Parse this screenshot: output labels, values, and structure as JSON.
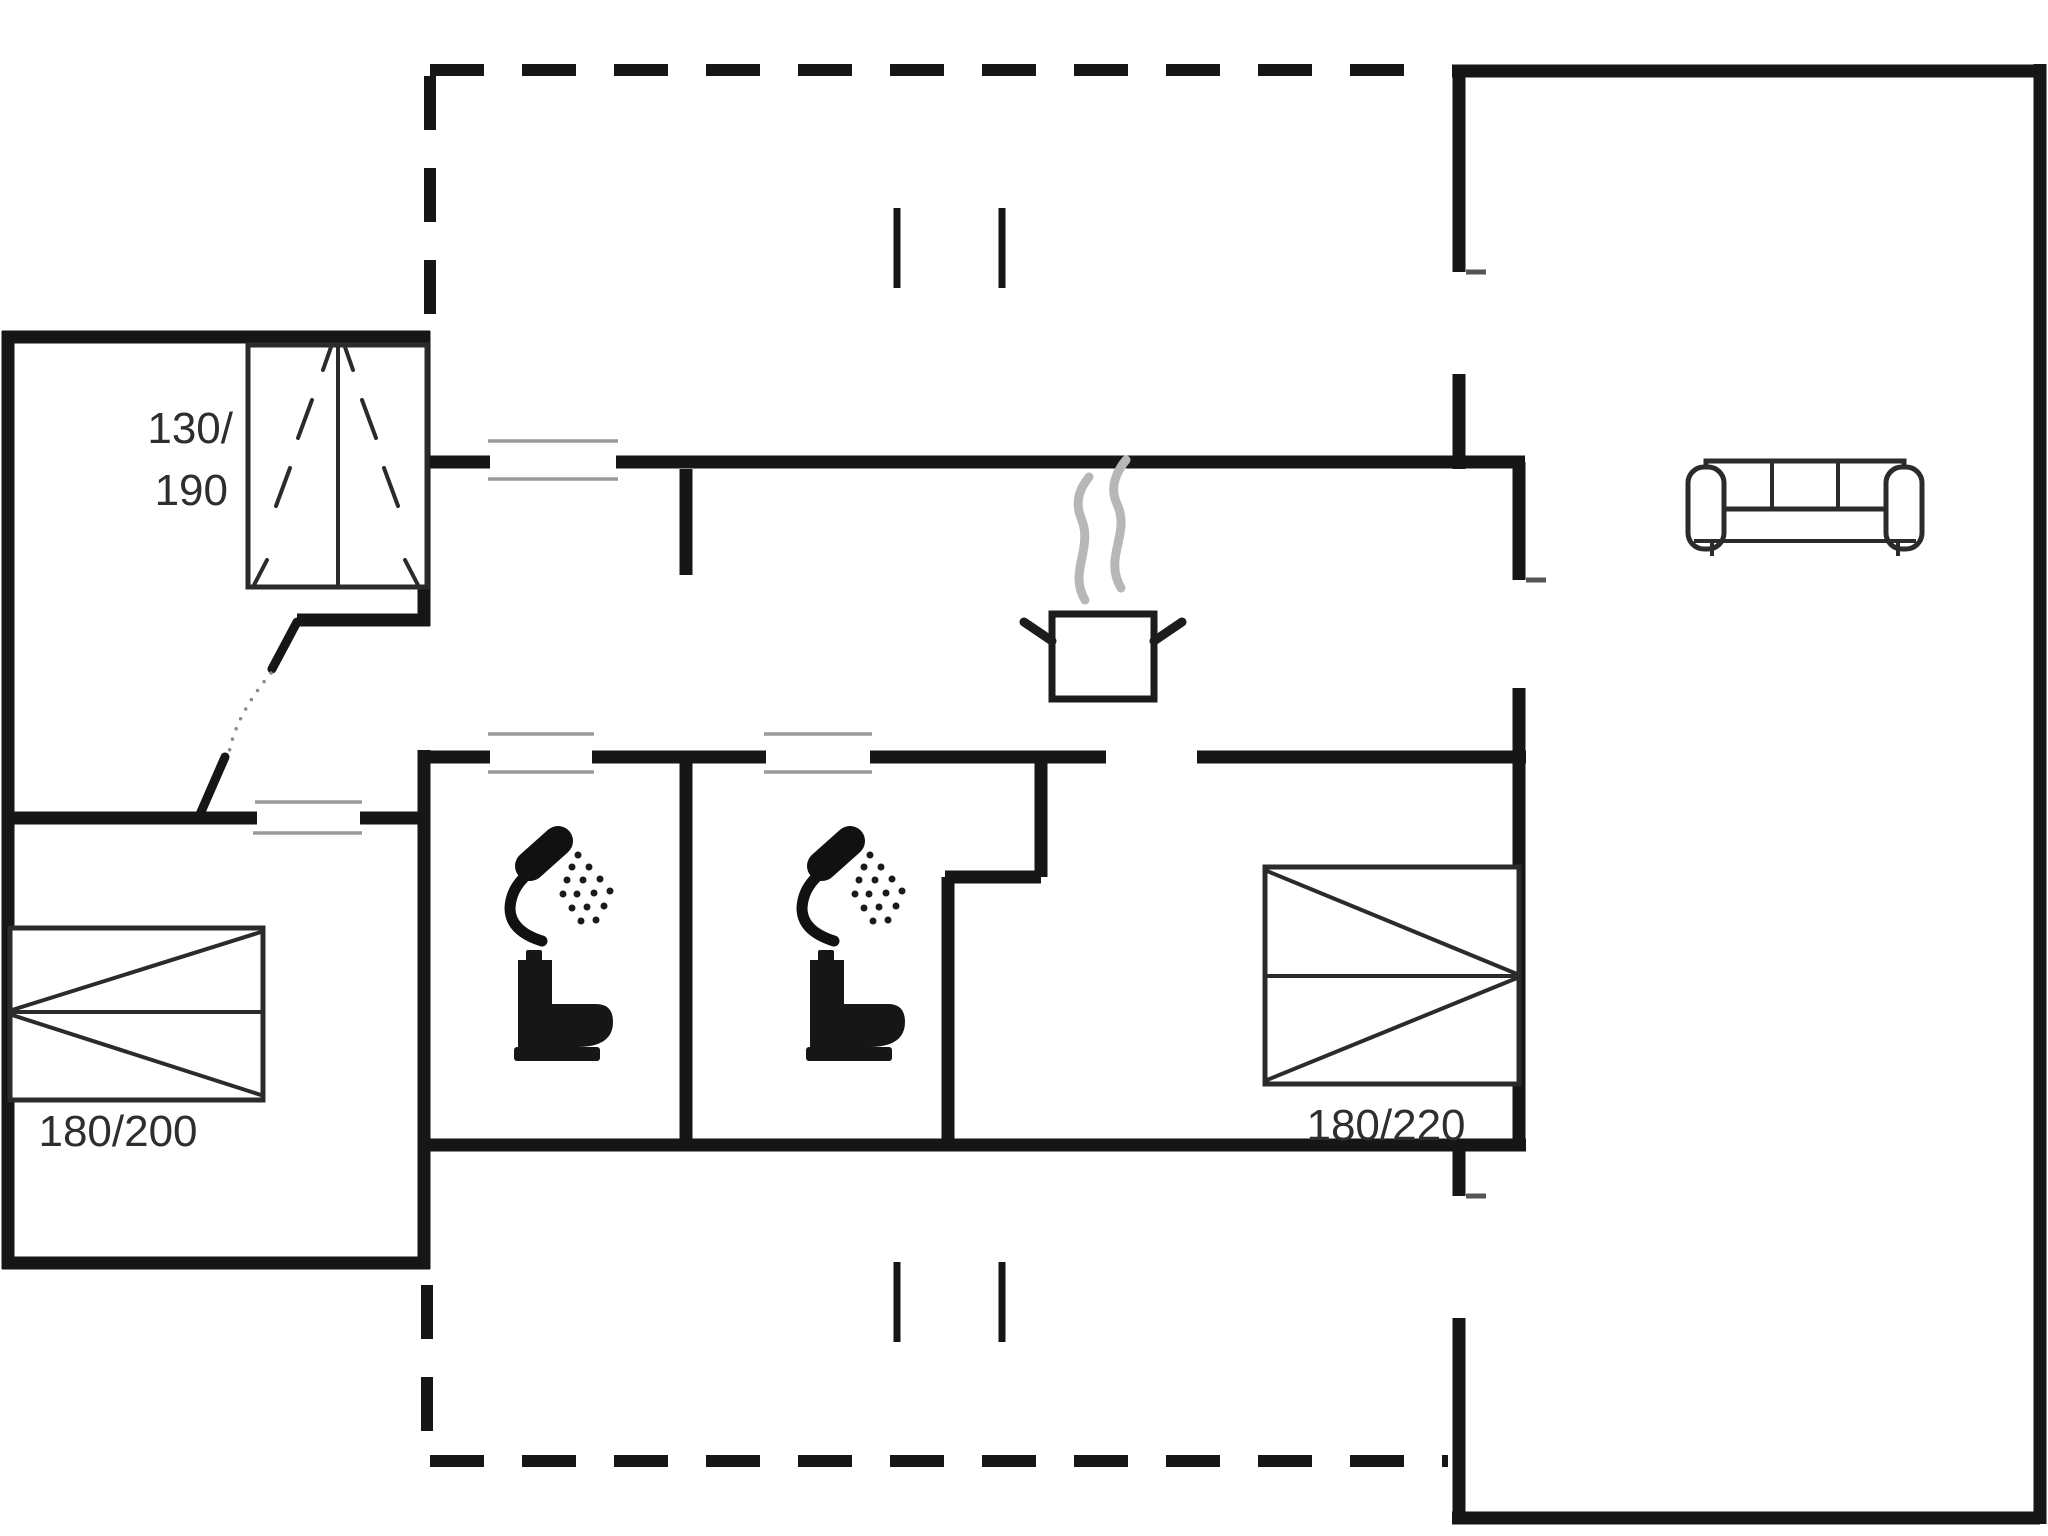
{
  "plan": {
    "type": "holiday-house-floor-plan",
    "beds": [
      {
        "name": "bed-top-left",
        "size_line1": "130/",
        "size_line2": "190"
      },
      {
        "name": "bed-bottom-left",
        "size_label": "180/200"
      },
      {
        "name": "bed-right",
        "size_label": "180/220"
      }
    ],
    "icons": [
      {
        "name": "steaming-pot-icon",
        "meaning": "kitchen / stove"
      },
      {
        "name": "sofa-icon",
        "meaning": "living room seating"
      },
      {
        "name": "shower-icon",
        "meaning": "bathroom 1 shower"
      },
      {
        "name": "toilet-icon",
        "meaning": "bathroom 1 toilet"
      },
      {
        "name": "shower-icon",
        "meaning": "bathroom 2 shower"
      },
      {
        "name": "toilet-icon",
        "meaning": "bathroom 2 toilet"
      }
    ]
  },
  "colors": {
    "wall": "#161616",
    "thin": "#2b2b2b",
    "window": "#9a9a9a",
    "steam": "#b7b7b7",
    "text": "#2e2e2e",
    "bg": "#ffffff"
  }
}
